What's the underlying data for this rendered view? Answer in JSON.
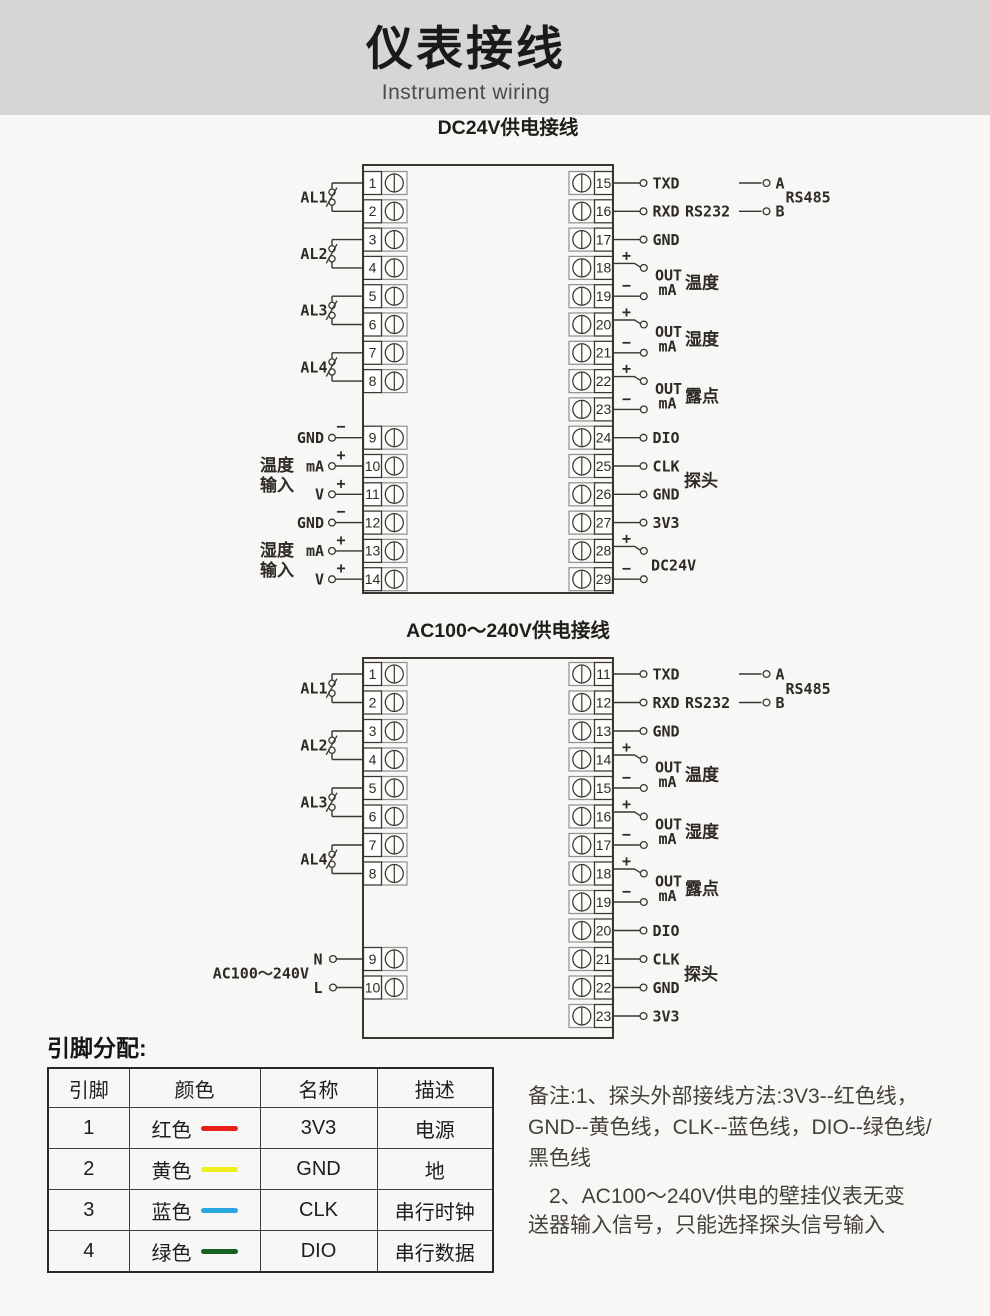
{
  "page": {
    "title": "仪表接线",
    "subtitle": "Instrument wiring",
    "bg": "#f7f7f6",
    "header_bg": "#d8d6d4",
    "line_color": "#3a3530",
    "ink": "#2f2a26"
  },
  "diagrams": [
    {
      "title": "DC24V供电接线",
      "left": {
        "alarms": [
          {
            "label": "AL1",
            "pins": [
              {
                "n": "1",
                "row": 0
              },
              {
                "n": "2",
                "row": 1
              }
            ]
          },
          {
            "label": "AL2",
            "pins": [
              {
                "n": "3",
                "row": 2
              },
              {
                "n": "4",
                "row": 3
              }
            ]
          },
          {
            "label": "AL3",
            "pins": [
              {
                "n": "5",
                "row": 4
              },
              {
                "n": "6",
                "row": 5
              }
            ]
          },
          {
            "label": "AL4",
            "pins": [
              {
                "n": "7",
                "row": 6
              },
              {
                "n": "8",
                "row": 7
              }
            ]
          }
        ],
        "signals": [
          {
            "n": "9",
            "row": 9,
            "label": "GND",
            "sign": "−"
          },
          {
            "n": "10",
            "row": 10,
            "label": "mA",
            "sign": "+"
          },
          {
            "n": "11",
            "row": 11,
            "label": "V",
            "sign": "+"
          },
          {
            "n": "12",
            "row": 12,
            "label": "GND",
            "sign": "−"
          },
          {
            "n": "13",
            "row": 13,
            "label": "mA",
            "sign": "+"
          },
          {
            "n": "14",
            "row": 14,
            "label": "V",
            "sign": "+"
          }
        ],
        "groups": [
          {
            "lines": [
              "温度",
              "输入"
            ],
            "rows": [
              10,
              11
            ]
          },
          {
            "lines": [
              "湿度",
              "输入"
            ],
            "rows": [
              13,
              14
            ]
          }
        ]
      },
      "right": {
        "pins": [
          {
            "n": "15",
            "row": 0,
            "label": "TXD"
          },
          {
            "n": "16",
            "row": 1,
            "label": "RXD"
          },
          {
            "n": "17",
            "row": 2,
            "label": "GND"
          },
          {
            "n": "18",
            "row": 3,
            "sign": "+"
          },
          {
            "n": "19",
            "row": 4,
            "sign": "−"
          },
          {
            "n": "20",
            "row": 5,
            "sign": "+"
          },
          {
            "n": "21",
            "row": 6,
            "sign": "−"
          },
          {
            "n": "22",
            "row": 7,
            "sign": "+"
          },
          {
            "n": "23",
            "row": 8,
            "sign": "−"
          },
          {
            "n": "24",
            "row": 9,
            "label": "DIO"
          },
          {
            "n": "25",
            "row": 10,
            "label": "CLK"
          },
          {
            "n": "26",
            "row": 11,
            "label": "GND"
          },
          {
            "n": "27",
            "row": 12,
            "label": "3V3"
          },
          {
            "n": "28",
            "row": 13,
            "sign": "+"
          },
          {
            "n": "29",
            "row": 14,
            "sign": "−"
          }
        ],
        "out_groups": [
          {
            "rows": [
              3,
              4
            ],
            "label1": "OUT",
            "label2": "mA",
            "category": "温度"
          },
          {
            "rows": [
              5,
              6
            ],
            "label1": "OUT",
            "label2": "mA",
            "category": "湿度"
          },
          {
            "rows": [
              7,
              8
            ],
            "label1": "OUT",
            "label2": "mA",
            "category": "露点"
          }
        ],
        "pair_labels": [
          {
            "rows": [
              13,
              14
            ],
            "label": "DC24V"
          }
        ],
        "rs232_label": "RS232",
        "rs232_row": 1,
        "probe_label": "探头",
        "probe_rows": [
          10,
          11
        ],
        "rs485": {
          "label": "RS485",
          "a": "A",
          "b": "B",
          "rows": [
            0,
            1
          ]
        }
      }
    },
    {
      "title": "AC100～240V供电接线",
      "left": {
        "alarms": [
          {
            "label": "AL1",
            "pins": [
              {
                "n": "1",
                "row": 0
              },
              {
                "n": "2",
                "row": 1
              }
            ]
          },
          {
            "label": "AL2",
            "pins": [
              {
                "n": "3",
                "row": 2
              },
              {
                "n": "4",
                "row": 3
              }
            ]
          },
          {
            "label": "AL3",
            "pins": [
              {
                "n": "5",
                "row": 4
              },
              {
                "n": "6",
                "row": 5
              }
            ]
          },
          {
            "label": "AL4",
            "pins": [
              {
                "n": "7",
                "row": 6
              },
              {
                "n": "8",
                "row": 7
              }
            ]
          }
        ],
        "signals": [],
        "groups": [],
        "power": {
          "label": "AC100～240V",
          "pins": [
            {
              "n": "9",
              "row": 10,
              "label": "N"
            },
            {
              "n": "10",
              "row": 11,
              "label": "L"
            }
          ]
        }
      },
      "right": {
        "pins": [
          {
            "n": "11",
            "row": 0,
            "label": "TXD"
          },
          {
            "n": "12",
            "row": 1,
            "label": "RXD"
          },
          {
            "n": "13",
            "row": 2,
            "label": "GND"
          },
          {
            "n": "14",
            "row": 3,
            "sign": "+"
          },
          {
            "n": "15",
            "row": 4,
            "sign": "−"
          },
          {
            "n": "16",
            "row": 5,
            "sign": "+"
          },
          {
            "n": "17",
            "row": 6,
            "sign": "−"
          },
          {
            "n": "18",
            "row": 7,
            "sign": "+"
          },
          {
            "n": "19",
            "row": 8,
            "sign": "−"
          },
          {
            "n": "20",
            "row": 9,
            "label": "DIO"
          },
          {
            "n": "21",
            "row": 10,
            "label": "CLK"
          },
          {
            "n": "22",
            "row": 11,
            "label": "GND"
          },
          {
            "n": "23",
            "row": 12,
            "label": "3V3"
          }
        ],
        "out_groups": [
          {
            "rows": [
              3,
              4
            ],
            "label1": "OUT",
            "label2": "mA",
            "category": "温度"
          },
          {
            "rows": [
              5,
              6
            ],
            "label1": "OUT",
            "label2": "mA",
            "category": "湿度"
          },
          {
            "rows": [
              7,
              8
            ],
            "label1": "OUT",
            "label2": "mA",
            "category": "露点"
          }
        ],
        "pair_labels": [],
        "rs232_label": "RS232",
        "rs232_row": 1,
        "probe_label": "探头",
        "probe_rows": [
          10,
          11
        ],
        "rs485": {
          "label": "RS485",
          "a": "A",
          "b": "B",
          "rows": [
            0,
            1
          ]
        }
      }
    }
  ],
  "pin_table": {
    "title": "引脚分配:",
    "headers": [
      "引脚",
      "颜色",
      "名称",
      "描述"
    ],
    "rows": [
      {
        "pin": "1",
        "color_name": "红色",
        "color": "#e8201c",
        "name": "3V3",
        "desc": "电源"
      },
      {
        "pin": "2",
        "color_name": "黄色",
        "color": "#f2ee1e",
        "name": "GND",
        "desc": "地"
      },
      {
        "pin": "3",
        "color_name": "蓝色",
        "color": "#2aa7e1",
        "name": "CLK",
        "desc": "串行时钟"
      },
      {
        "pin": "4",
        "color_name": "绿色",
        "color": "#15611f",
        "name": "DIO",
        "desc": "串行数据"
      }
    ]
  },
  "notes": {
    "para1": [
      "备注:1、探头外部接线方法:3V3--红色线，",
      "GND--黄色线，CLK--蓝色线，DIO--绿色线/",
      "黑色线"
    ],
    "para2": [
      "　2、AC100～240V供电的壁挂仪表无变",
      "送器输入信号，只能选择探头信号输入"
    ]
  }
}
